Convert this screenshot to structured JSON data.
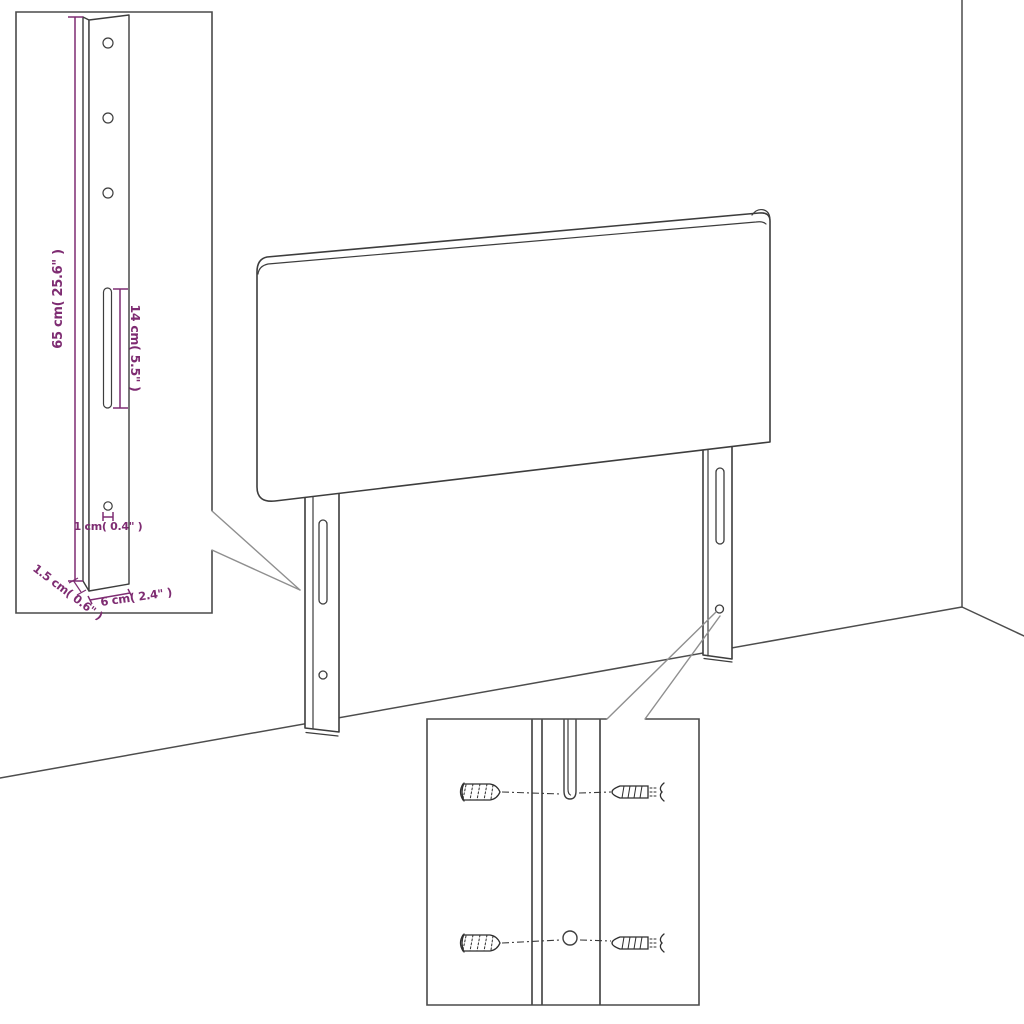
{
  "diagram": {
    "type": "product-dimension-diagram",
    "product": "upholstered-headboard-with-mounting-legs",
    "colors": {
      "line": "#3d3d3d",
      "dimension": "#7e2c72",
      "callout": "#8f8f8f",
      "background": "#ffffff"
    },
    "labels": {
      "leg_height": "65 cm( 25.6\" )",
      "slot_length": "14 cm( 5.5\" )",
      "hole_diameter": "1 cm( 0.4\" )",
      "leg_thickness": "1.5 cm( 0.6\" )",
      "leg_width": "6 cm( 2.4\" )"
    }
  }
}
